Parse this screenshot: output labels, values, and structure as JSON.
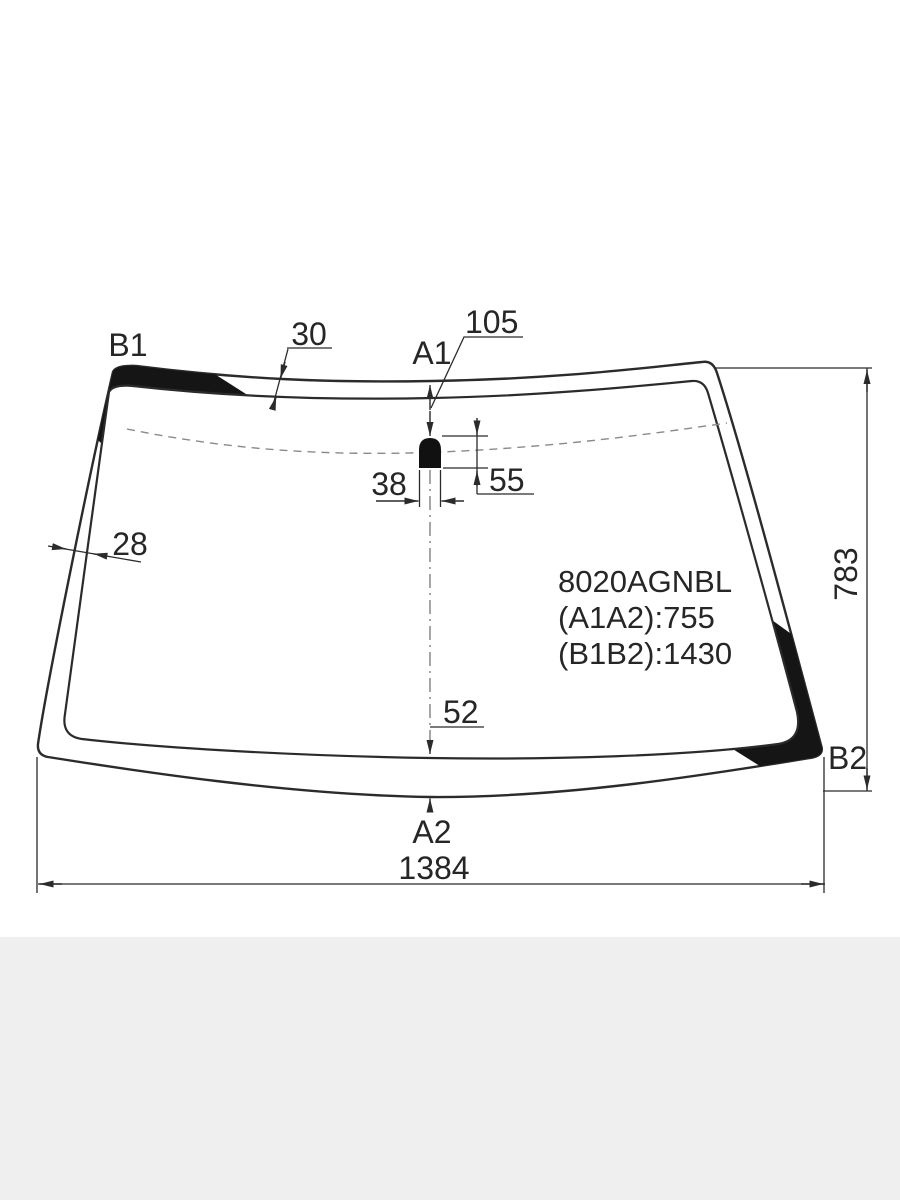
{
  "diagram": {
    "type": "windshield-dimension-drawing",
    "part_number": "8020AGNBL",
    "specs": {
      "a1a2": "(A1A2):755",
      "b1b2": "(B1B2):1430"
    },
    "point_labels": {
      "b1": "B1",
      "a1": "A1",
      "b2": "B2",
      "a2": "A2"
    },
    "dimensions": {
      "top_band_width": "30",
      "sensor_offset_from_top": "105",
      "sensor_width": "38",
      "sensor_height": "55",
      "side_band_width": "28",
      "bottom_band_height": "52",
      "overall_height": "783",
      "overall_width": "1384"
    },
    "colors": {
      "line": "#2b2b2b",
      "tint_band": "#151515",
      "background": "#ffffff",
      "footer_background": "#efefef"
    }
  }
}
